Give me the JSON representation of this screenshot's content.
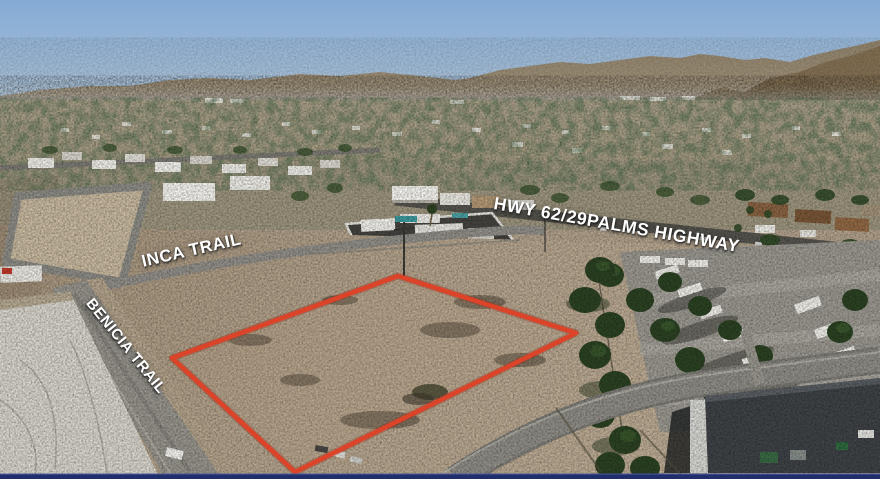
{
  "photo": {
    "kind": "aerial-drone-photo-of-vacant-land-listing",
    "labels": {
      "street_inca": "INCA TRAIL",
      "street_benicia": "BENICIA TRAIL",
      "highway": "HWY 62/29PALMS HIGHWAY"
    },
    "parcel_outline": {
      "color": "#dc4328",
      "points": "398,276 576,333 295,472 172,358"
    },
    "frame": {
      "bottom_bar_color": "#202e6b"
    },
    "palette": {
      "sky_top": "#84abd6",
      "sky_horizon": "#c3cfd8",
      "mountains_far": "#95866c",
      "mountain_right": "#7e6c50",
      "valley": "#a89f87",
      "dirt": "#b2a28c",
      "road": "#98958d",
      "rock_slope": "#d9d6cd",
      "tree_green": "#2c4323"
    }
  }
}
